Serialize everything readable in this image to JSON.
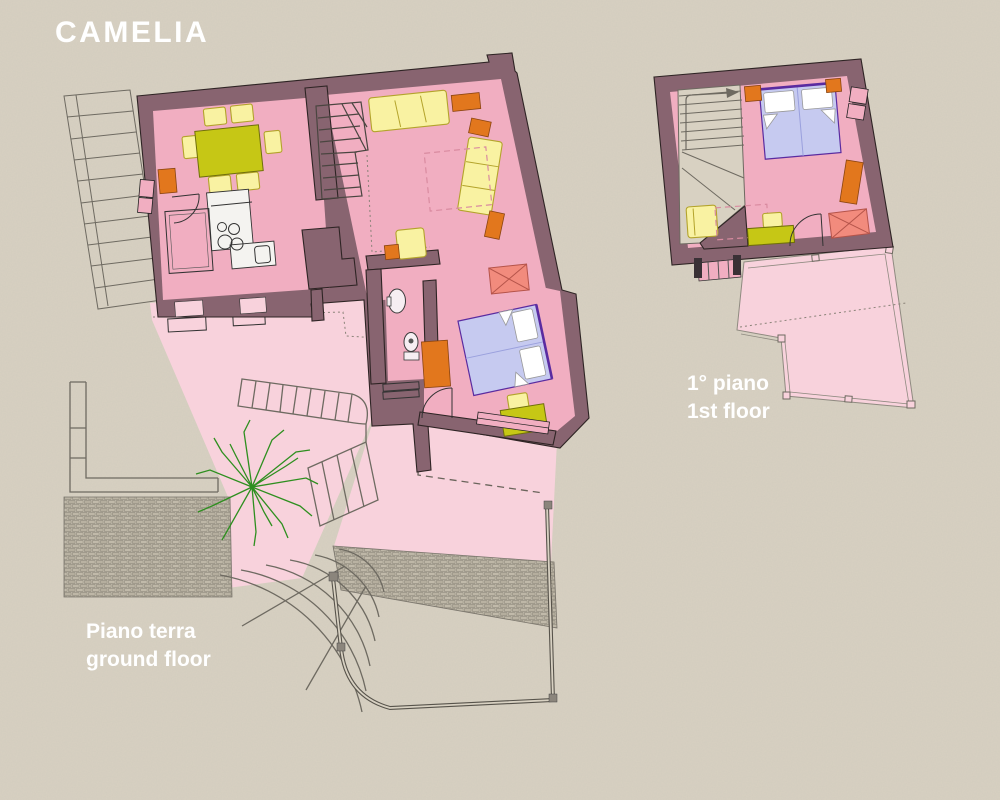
{
  "title": "CAMELIA",
  "plans": [
    {
      "id": "ground-floor",
      "label_it": "Piano terra",
      "label_en": "ground floor"
    },
    {
      "id": "first-floor",
      "label_it": "1° piano",
      "label_en": "1st floor"
    }
  ],
  "icons": [
    "tree-icon",
    "stairs-icon",
    "bed-icon",
    "sofa-icon",
    "table-icon",
    "toilet-icon",
    "sink-icon",
    "fireplace-icon",
    "door-arc-icon"
  ],
  "colors": {
    "bg": "#d8d1c2",
    "wall": "#886470",
    "wallline": "#2e2424",
    "floor": "#f1aec1",
    "terrace": "#f8d2dc",
    "fyellow": "#f9f2a2",
    "tgreen": "#c6c715",
    "orange": "#e2771d",
    "bblue": "#c6caf0",
    "bedline": "#5a2ba0",
    "salmon": "#f28b7d",
    "tree": "#2e8f1f",
    "gray": "#6e6a61",
    "white": "#ffffff"
  }
}
